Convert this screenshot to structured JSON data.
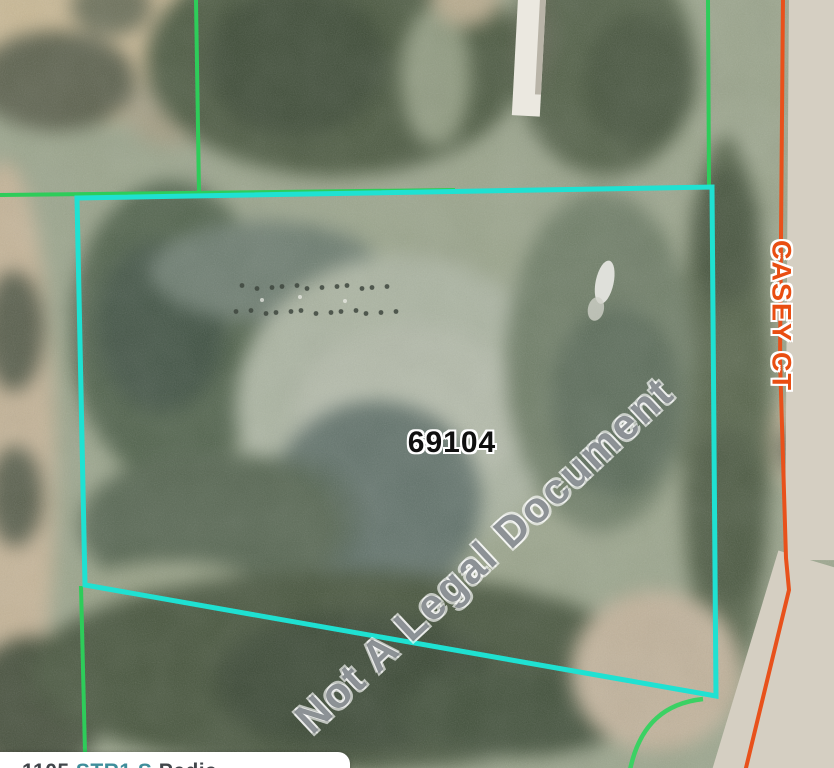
{
  "map": {
    "parcel_label": "69104",
    "street_label": "CASEY CT",
    "watermark_text": "Not A Legal Document",
    "info_box": {
      "text_part1": "1105 ",
      "text_part2": "STR1 S ",
      "text_part3": "Pedia"
    },
    "colors": {
      "parcel_boundary": "#1fe1d2",
      "property_lines": "#2ecc5a",
      "corner_curve": "#3bd163",
      "road_centerline": "#e8511b",
      "street_label_color": "#e94e12",
      "parcel_label_color": "#101010",
      "watermark_color": "#7d8388",
      "road_pavement": "#d5cfc2"
    }
  }
}
